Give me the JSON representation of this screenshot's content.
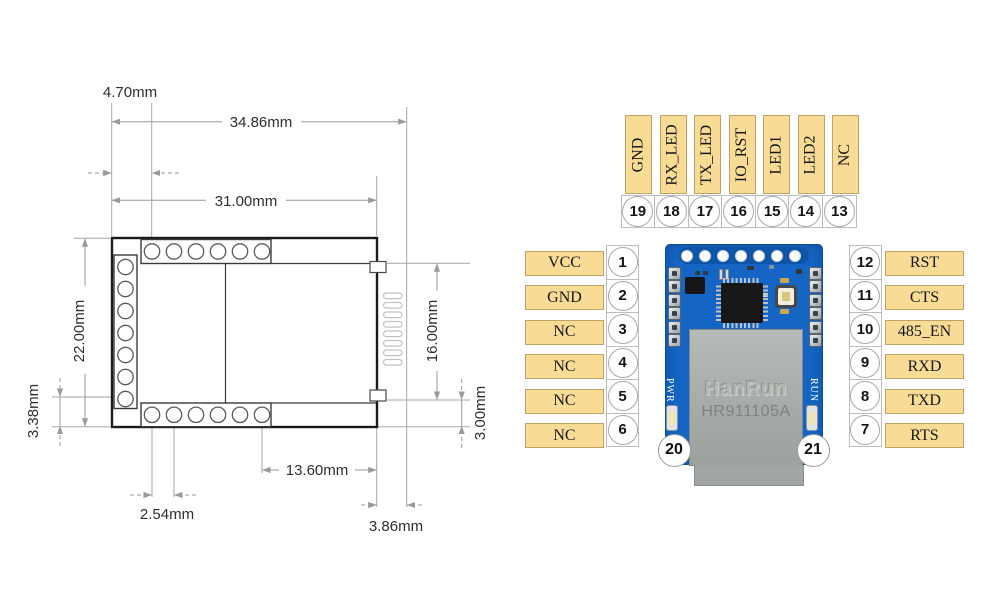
{
  "drawing": {
    "dimensions": {
      "pin_offset_top": "4.70mm",
      "overall_width": "34.86mm",
      "pin_row_width": "31.00mm",
      "overall_height": "22.00mm",
      "pin_edge_bottom": "3.38mm",
      "connector_span": "16.00mm",
      "tab_to_edge": "3.00mm",
      "pin_to_right_edge": "13.60mm",
      "pin_pitch": "2.54mm",
      "plug_offset": "3.86mm"
    }
  },
  "pinout": {
    "top_pins": [
      {
        "num": "19",
        "label": "GND"
      },
      {
        "num": "18",
        "label": "RX_LED"
      },
      {
        "num": "17",
        "label": "TX_LED"
      },
      {
        "num": "16",
        "label": "IO_RST"
      },
      {
        "num": "15",
        "label": "LED1"
      },
      {
        "num": "14",
        "label": "LED2"
      },
      {
        "num": "13",
        "label": "NC"
      }
    ],
    "left_pins": [
      {
        "num": "1",
        "label": "VCC"
      },
      {
        "num": "2",
        "label": "GND"
      },
      {
        "num": "3",
        "label": "NC"
      },
      {
        "num": "4",
        "label": "NC"
      },
      {
        "num": "5",
        "label": "NC"
      },
      {
        "num": "6",
        "label": "NC"
      }
    ],
    "right_pins": [
      {
        "num": "12",
        "label": "RST"
      },
      {
        "num": "11",
        "label": "CTS"
      },
      {
        "num": "10",
        "label": "485_EN"
      },
      {
        "num": "9",
        "label": "RXD"
      },
      {
        "num": "8",
        "label": "TXD"
      },
      {
        "num": "7",
        "label": "RTS"
      }
    ],
    "bottom_pins": [
      {
        "num": "20",
        "label": "PWR"
      },
      {
        "num": "21",
        "label": "RUN"
      }
    ],
    "module": {
      "brand": "HanRun",
      "part": "HR911105A"
    },
    "colors": {
      "label_bg": "#f8dc96",
      "label_border": "#bfa265",
      "pcb_blue": "#1566c4",
      "connector_gray": "#a9ada9"
    }
  }
}
